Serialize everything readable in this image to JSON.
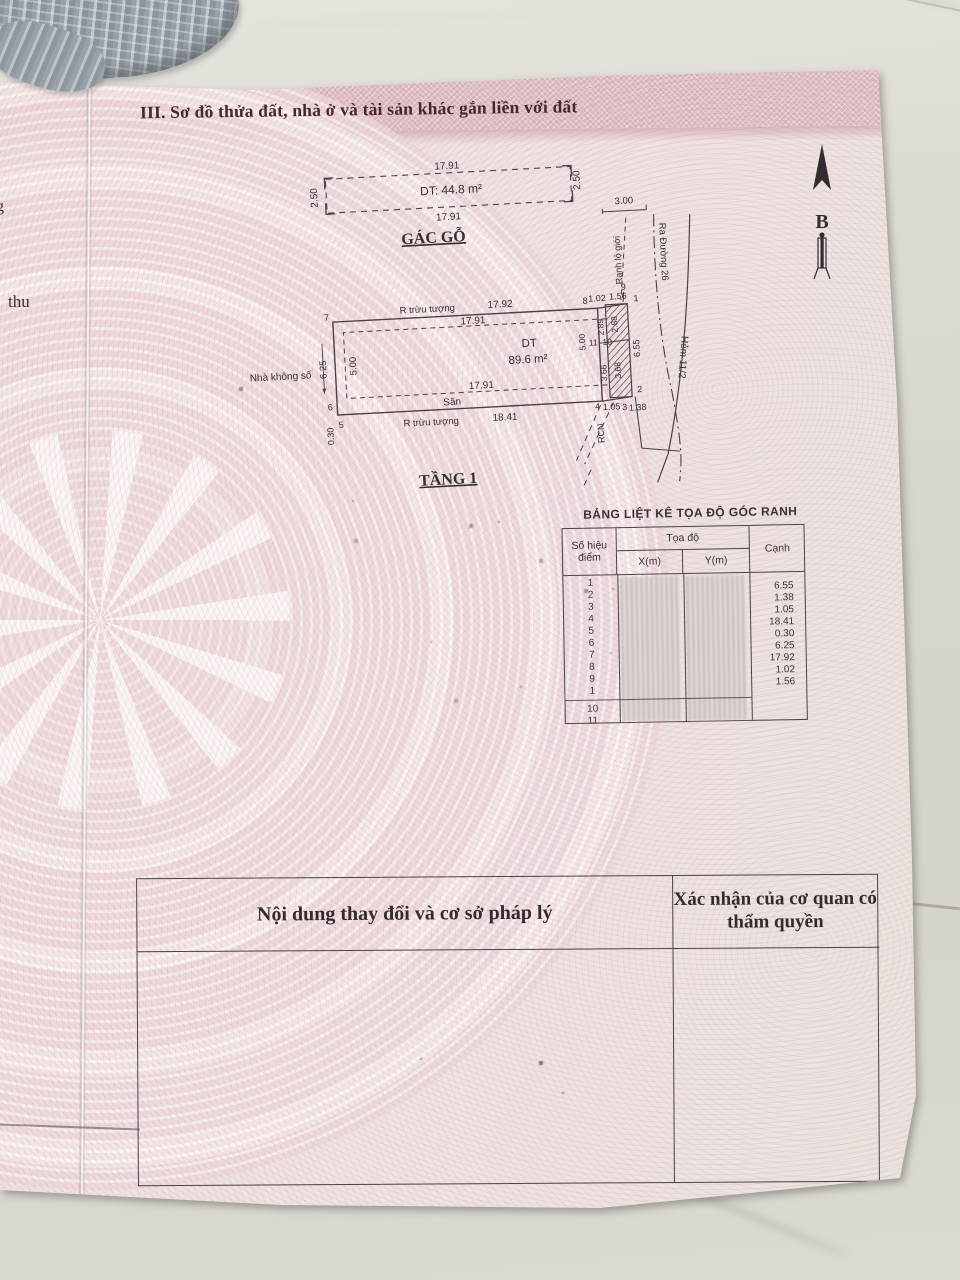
{
  "photo": {
    "fragment_g": "g",
    "fragment_thu": "thu"
  },
  "doc": {
    "section_title": "III. Sơ đồ thửa đất, nhà ở và tài sản khác gắn liền với đất",
    "compass_label": "B",
    "gac_go": {
      "title": "GÁC GỖ",
      "dim_top": "17.91",
      "area": "DT: 44.8 m²",
      "dim_bottom": "17.91",
      "dim_left": "2.50",
      "dim_right": "2.50"
    },
    "tang1": {
      "title": "TẦNG 1",
      "house_label": "Nhà không số",
      "edge_top_label": "R trừu tượng",
      "edge_top_value": "17.92",
      "inner_top": "17.91",
      "area_label": "DT",
      "area_value": "89.6 m²",
      "inner_bottom": "17.91",
      "san_label": "Sân",
      "edge_bottom_label": "R trừu tượng",
      "edge_bottom_value": "18.41",
      "left_outer": "6.25",
      "left_inner": "5.00",
      "left_bottom": "0.30",
      "right_inner": "5.00",
      "p7": "7",
      "p6": "6",
      "p5": "5",
      "p8": "8",
      "d102": "1.02",
      "d156": "1.56",
      "p1": "1",
      "p9": "9",
      "s289": "2.89",
      "s288": "2.88",
      "p11": "11",
      "p10": "10",
      "s366": "3.66",
      "s368": "3.68",
      "d655": "6.55",
      "p4": "4",
      "d105": "1.05",
      "p3": "3",
      "d138": "1.38",
      "p2": "2",
      "rcn": "RCN"
    },
    "streets": {
      "width": "3.00",
      "ranh_lo_gioi": "Ranh lộ giới",
      "ra_duong": "Ra Đường 26",
      "hem": "Hẻm 11/2"
    },
    "coord_table": {
      "title": "BẢNG LIỆT KÊ TỌA ĐỘ GÓC RANH",
      "col_point": "Số hiệu điểm",
      "col_coords": "Tọa độ",
      "col_x": "X(m)",
      "col_y": "Y(m)",
      "col_edge": "Cạnh",
      "points": [
        "1",
        "2",
        "3",
        "4",
        "5",
        "6",
        "7",
        "8",
        "9",
        "1"
      ],
      "extra_points": [
        "10",
        "11"
      ],
      "edges": [
        "6.55",
        "1.38",
        "1.05",
        "18.41",
        "0.30",
        "6.25",
        "17.92",
        "1.02",
        "1.56"
      ]
    },
    "bottom_table": {
      "left_header": "Nội dung thay đổi và cơ sở pháp lý",
      "right_header": "Xác nhận của cơ quan có thẩm quyền"
    },
    "colors": {
      "paper": "#efe0e0",
      "band": "#dcb5bd",
      "ink": "#3a3236",
      "title_ink": "#44262b",
      "tile": "#d9d8d0"
    }
  }
}
